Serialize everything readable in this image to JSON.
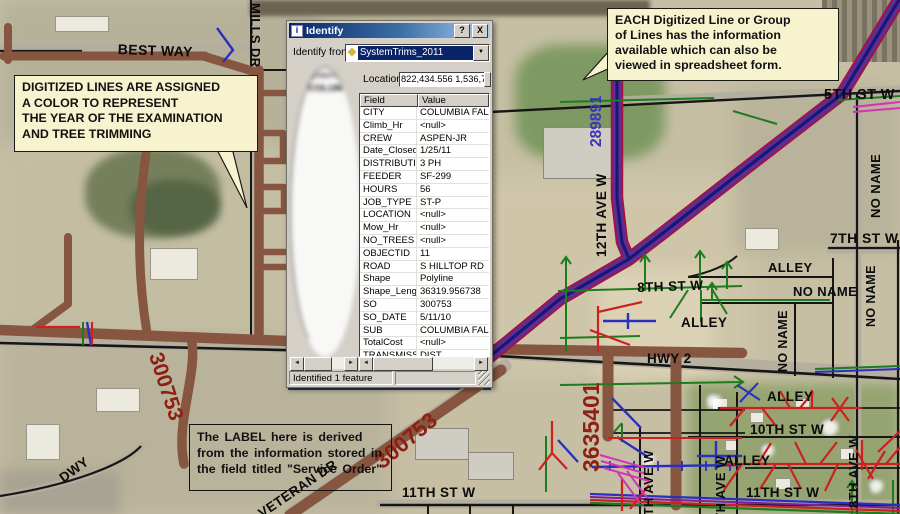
{
  "callouts": {
    "top_left": {
      "lines": [
        "DIGITIZED LINES ARE ASSIGNED",
        "A COLOR TO REPRESENT",
        "THE YEAR OF THE EXAMINATION",
        "AND TREE TRIMMING"
      ]
    },
    "top_right": {
      "lines": [
        "EACH Digitized Line or Group",
        "of Lines has the information",
        "available which can also be",
        "viewed in spreadsheet form."
      ]
    },
    "bottom": {
      "lines": [
        "The  LABEL  here  is  derived",
        "from the information stored in",
        "the field titled \"Service Order\""
      ]
    }
  },
  "dialog": {
    "title": "Identify",
    "help_button": "?",
    "close_button": "X",
    "identify_from_label": "Identify from:",
    "layer_name": "SystemTrims_2011",
    "tree": {
      "root": "SystemTrims_2011",
      "child": "COLUMBIA FALLS"
    },
    "location_label": "Location:",
    "location_value": "822,434.556 1,536,726.",
    "status": "Identified 1 feature",
    "table": {
      "headers": [
        "Field",
        "Value"
      ],
      "rows": [
        [
          "CITY",
          "COLUMBIA FALLS"
        ],
        [
          "Climb_Hr",
          "<null>"
        ],
        [
          "CREW",
          "ASPEN-JR"
        ],
        [
          "Date_Closed",
          "1/25/11"
        ],
        [
          "DISTRIBUTI",
          "3 PH"
        ],
        [
          "FEEDER",
          "SF-299"
        ],
        [
          "HOURS",
          "56"
        ],
        [
          "JOB_TYPE",
          "ST-P"
        ],
        [
          "LOCATION",
          "<null>"
        ],
        [
          "Mow_Hr",
          "<null>"
        ],
        [
          "NO_TREES",
          "<null>"
        ],
        [
          "OBJECTID",
          "11"
        ],
        [
          "ROAD",
          "S HILLTOP RD"
        ],
        [
          "Shape",
          "Polyline"
        ],
        [
          "Shape_Length",
          "36319.956738"
        ],
        [
          "SO",
          "300753"
        ],
        [
          "SO_DATE",
          "5/11/10"
        ],
        [
          "SUB",
          "COLUMBIA FALLS"
        ],
        [
          "TotalCost",
          "<null>"
        ],
        [
          "TRANSMISSI",
          "DIST"
        ],
        [
          "WORKORDER",
          "<null>"
        ]
      ]
    }
  },
  "map_labels": {
    "streets": [
      {
        "text": "BEST WAY",
        "x": 118,
        "y": 42,
        "rot": 2,
        "fs": 14
      },
      {
        "text": "MILLS DR",
        "x": 262,
        "y": 3,
        "rot": 90,
        "fs": 13
      },
      {
        "text": "5TH ST W",
        "x": 824,
        "y": 88,
        "rot": 0,
        "fs": 14.5
      },
      {
        "text": "7TH ST W",
        "x": 830,
        "y": 231,
        "rot": 0,
        "fs": 14
      },
      {
        "text": "NO NAME",
        "x": 869,
        "y": 218,
        "rot": -90,
        "fs": 13
      },
      {
        "text": "ALLEY",
        "x": 768,
        "y": 261,
        "rot": 0,
        "fs": 13
      },
      {
        "text": "NO NAME",
        "x": 793,
        "y": 285,
        "rot": 0,
        "fs": 13
      },
      {
        "text": "NO NAME",
        "x": 777,
        "y": 372,
        "rot": -90,
        "fs": 12.5
      },
      {
        "text": "NO NAME",
        "x": 865,
        "y": 327,
        "rot": -90,
        "fs": 12.5
      },
      {
        "text": "8TH ST W",
        "x": 637,
        "y": 281,
        "rot": -2,
        "fs": 13.5
      },
      {
        "text": "ALLEY",
        "x": 681,
        "y": 316,
        "rot": 0,
        "fs": 13.5
      },
      {
        "text": "HWY 2",
        "x": 647,
        "y": 352,
        "rot": 0,
        "fs": 13.5
      },
      {
        "text": "ALLEY",
        "x": 767,
        "y": 390,
        "rot": 0,
        "fs": 13.5
      },
      {
        "text": "10TH ST W",
        "x": 750,
        "y": 423,
        "rot": 0,
        "fs": 13.5
      },
      {
        "text": "ALLEY",
        "x": 724,
        "y": 454,
        "rot": 0,
        "fs": 13.5
      },
      {
        "text": "11TH ST W",
        "x": 746,
        "y": 486,
        "rot": 0,
        "fs": 13.5
      },
      {
        "text": "11TH ST W",
        "x": 402,
        "y": 486,
        "rot": 0,
        "fs": 13.5
      },
      {
        "text": "8TH AVE W",
        "x": 847,
        "y": 508,
        "rot": -90,
        "fs": 13
      },
      {
        "text": "11TH AVE W",
        "x": 642,
        "y": 530,
        "rot": -90,
        "fs": 13
      },
      {
        "text": "10TH AVE W",
        "x": 714,
        "y": 536,
        "rot": -90,
        "fs": 13
      },
      {
        "text": "12TH AVE W",
        "x": 595,
        "y": 257,
        "rot": -90,
        "fs": 13.5
      },
      {
        "text": "VETERAN DR",
        "x": 256,
        "y": 509,
        "rot": -34,
        "fs": 13.5
      },
      {
        "text": "DWY",
        "x": 57,
        "y": 474,
        "rot": -36,
        "fs": 13.5
      }
    ],
    "orders": [
      {
        "text": "300753",
        "x": 165,
        "y": 350,
        "rot": 72,
        "fs": 21,
        "color": "#8e1f12"
      },
      {
        "text": "300753",
        "x": 371,
        "y": 456,
        "rot": -40,
        "fs": 22,
        "color": "#8e1f12"
      },
      {
        "text": "3635401",
        "x": 580,
        "y": 472,
        "rot": -90,
        "fs": 23,
        "color": "#8e1f12"
      },
      {
        "text": "289891",
        "x": 589,
        "y": 147,
        "rot": -90,
        "fs": 15.5,
        "color": "#3d33b8"
      }
    ]
  },
  "colors": {
    "black_road": "#161616",
    "photo_road": "#b3ae9e",
    "trim_brown": "#875640",
    "dist_green": "#1e7b1e",
    "elec_red": "#cd2021",
    "elec_blue": "#2b2fbf",
    "magenta": "#d633b8",
    "route_purple": "#5b2e96",
    "route_core": "#1d1670",
    "route_edge": "#aa0f3e",
    "band_purple": "#7a1fa0",
    "order_red": "#8e1f12",
    "order_blue": "#3d33b8",
    "callout_bg": "#f8f3cf",
    "titlebar_blue": "#0a246a"
  }
}
